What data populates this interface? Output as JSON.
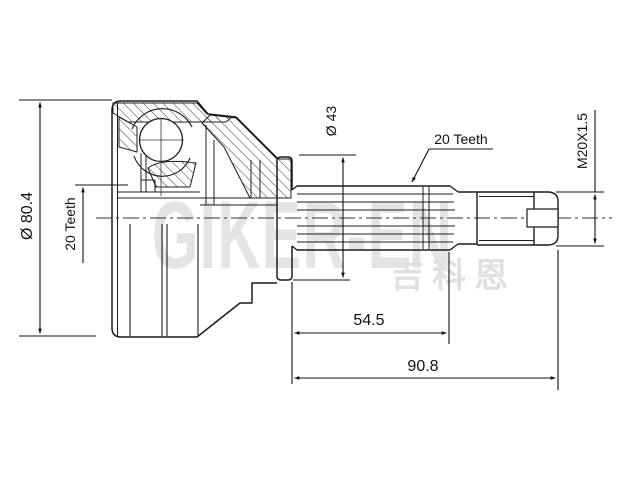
{
  "drawing": {
    "kind": "technical-drawing",
    "subject": "cv-joint-outer-half-section",
    "labels": {
      "housing_od": "Ø 80.4",
      "housing_teeth": "20 Teeth",
      "boot_od": "Ø 43",
      "shaft_teeth": "20 Teeth",
      "thread": "M20X1.5",
      "spline_len": "54.5",
      "total_len": "90.8"
    },
    "watermark": {
      "brand": "GIKER-EN",
      "brand_cn": "吉科恩"
    },
    "colors": {
      "line": "#1c1c1c",
      "watermark": "#e4e4e4",
      "background": "#ffffff"
    }
  }
}
